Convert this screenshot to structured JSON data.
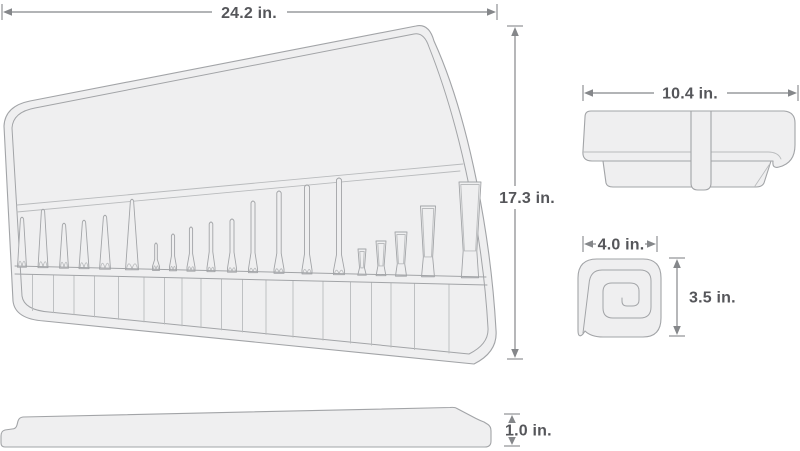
{
  "page": {
    "background": "#ffffff",
    "description": "Dimension line-art diagram of a punch and chisel set in a roll-up tool pouch"
  },
  "colors": {
    "bg": "#ffffff",
    "fill": "#efeff0",
    "outline": "#a2a4a7",
    "detail": "#b9bbbd",
    "dim": "#85878a",
    "text": "#55565a"
  },
  "views": {
    "unrolled": {
      "width": "24.2 in.",
      "height": "17.3 in."
    },
    "rolled_front": {
      "width": "10.4 in."
    },
    "rolled_end": {
      "width": "4.0 in.",
      "height": "3.5 in."
    },
    "side_profile": {
      "thickness": "1.0 in."
    }
  },
  "tools": [
    {
      "type": "taper",
      "x": 22,
      "top": 217,
      "b": 9
    },
    {
      "type": "taper",
      "x": 43,
      "top": 209,
      "b": 10
    },
    {
      "type": "taper",
      "x": 64,
      "top": 223,
      "b": 9
    },
    {
      "type": "taper",
      "x": 84,
      "top": 220,
      "b": 10
    },
    {
      "type": "taper",
      "x": 105,
      "top": 215,
      "b": 11
    },
    {
      "type": "taper",
      "x": 132,
      "top": 199,
      "b": 13
    },
    {
      "type": "pin",
      "x": 156,
      "top": 243,
      "s": 2.6,
      "b": 7
    },
    {
      "type": "pin",
      "x": 173,
      "top": 234,
      "s": 3.2,
      "b": 7
    },
    {
      "type": "pin",
      "x": 191,
      "top": 227,
      "s": 3.2,
      "b": 8
    },
    {
      "type": "pin",
      "x": 211,
      "top": 222,
      "s": 3.6,
      "b": 8
    },
    {
      "type": "pin",
      "x": 232,
      "top": 219,
      "s": 4,
      "b": 9
    },
    {
      "type": "pin",
      "x": 253,
      "top": 201,
      "s": 4,
      "b": 9
    },
    {
      "type": "pin",
      "x": 279,
      "top": 191,
      "s": 4.4,
      "b": 10
    },
    {
      "type": "pin",
      "x": 307,
      "top": 185,
      "s": 5,
      "b": 10
    },
    {
      "type": "pin",
      "x": 339,
      "top": 178,
      "s": 5,
      "b": 11
    },
    {
      "type": "chisel",
      "x": 362,
      "top": 249,
      "tw": 8
    },
    {
      "type": "chisel",
      "x": 381,
      "top": 241,
      "tw": 10
    },
    {
      "type": "chisel",
      "x": 401,
      "top": 232,
      "tw": 12
    },
    {
      "type": "chisel",
      "x": 428,
      "top": 206,
      "tw": 15
    },
    {
      "type": "chisel",
      "x": 470,
      "top": 182,
      "tw": 22
    }
  ]
}
